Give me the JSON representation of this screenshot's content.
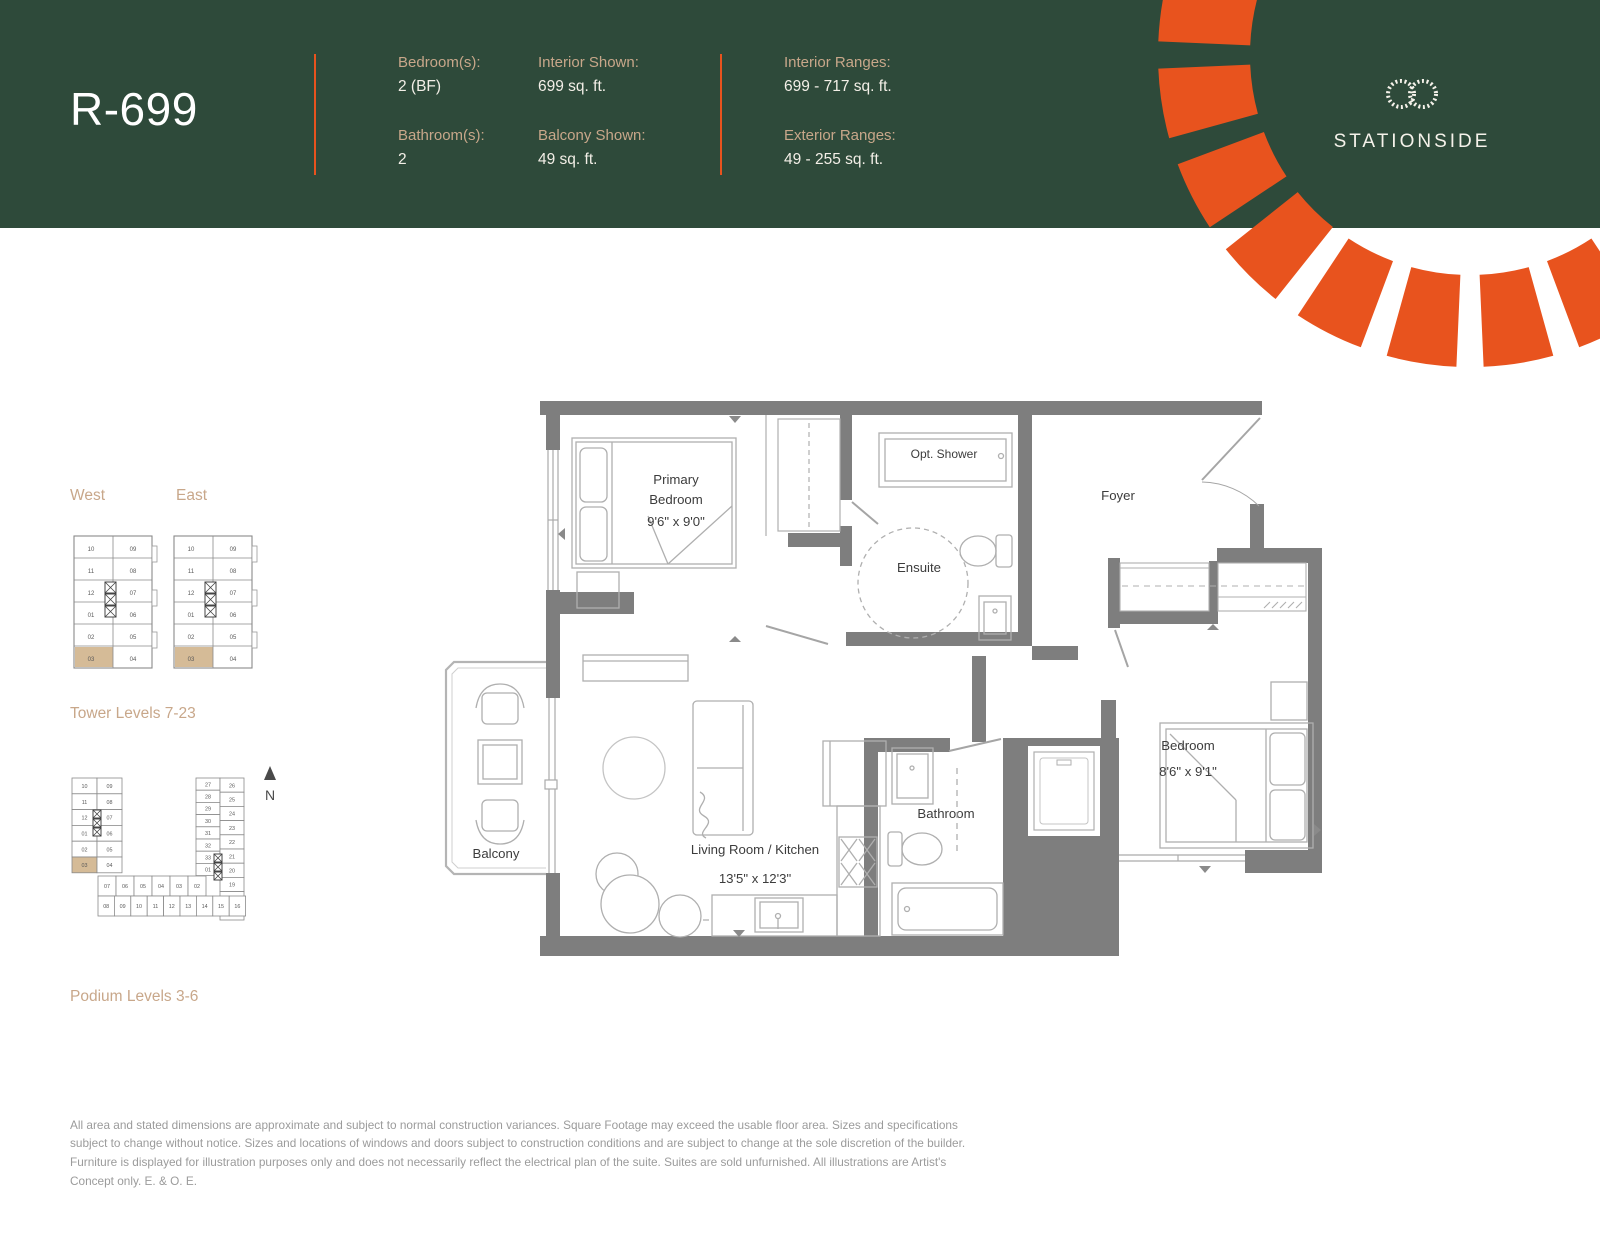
{
  "header": {
    "plan_code": "R-699",
    "specs": [
      {
        "label": "Bedroom(s):",
        "value": "2 (BF)"
      },
      {
        "label": "Bathroom(s):",
        "value": "2"
      },
      {
        "label": "Interior Shown:",
        "value": "699 sq. ft."
      },
      {
        "label": "Balcony Shown:",
        "value": "49 sq. ft."
      },
      {
        "label": "Interior Ranges:",
        "value": "699 - 717 sq. ft."
      },
      {
        "label": "Exterior Ranges:",
        "value": "49 - 255 sq. ft."
      }
    ],
    "brand": "STATIONSIDE",
    "colors": {
      "green": "#2E4A3A",
      "orange": "#E8531E",
      "tan": "#C8A78A",
      "highlight": "#D5BB97"
    }
  },
  "keyplans": {
    "west_label": "West",
    "east_label": "East",
    "tower_caption": "Tower Levels 7-23",
    "podium_caption": "Podium Levels 3-6",
    "north_label": "N",
    "highlight_unit": "03",
    "tower_left_units": [
      "10",
      "11",
      "12",
      "01",
      "02",
      "03"
    ],
    "tower_right_units": [
      "09",
      "08",
      "07",
      "06",
      "05",
      "04"
    ],
    "podium": {
      "tl_left": [
        "10",
        "11",
        "12",
        "01",
        "02",
        "03"
      ],
      "tl_right": [
        "09",
        "08",
        "07",
        "06",
        "05",
        "04"
      ],
      "right_inner": [
        "27",
        "28",
        "29",
        "30",
        "31",
        "32",
        "33",
        "01"
      ],
      "right_outer": [
        "26",
        "25",
        "24",
        "23",
        "22",
        "21",
        "20",
        "19",
        "18",
        "17"
      ],
      "bottom_top": [
        "07",
        "06",
        "05",
        "04",
        "03",
        "02"
      ],
      "bottom_bottom": [
        "08",
        "09",
        "10",
        "11",
        "12",
        "13",
        "14",
        "15",
        "16"
      ]
    }
  },
  "floorplan": {
    "labels": {
      "primary_1": "Primary",
      "primary_2": "Bedroom",
      "primary_dim": "9'6\" x 9'0\"",
      "opt_shower": "Opt. Shower",
      "ensuite": "Ensuite",
      "foyer": "Foyer",
      "bedroom": "Bedroom",
      "bedroom_dim": "8'6\" x 9'1\"",
      "bathroom": "Bathroom",
      "living": "Living Room / Kitchen",
      "living_dim": "13'5\" x 12'3\"",
      "balcony": "Balcony"
    }
  },
  "disclaimer": "All area and stated dimensions are approximate and subject to normal construction variances. Square Footage may exceed the usable floor area. Sizes and specifications subject to change without notice. Sizes and locations of windows and doors subject to construction conditions and are subject to change at the sole discretion of the builder. Furniture is displayed for illustration purposes only and does not necessarily reflect the electrical plan of the suite. Suites are sold unfurnished. All illustrations are Artist's Concept only. E. & O. E."
}
